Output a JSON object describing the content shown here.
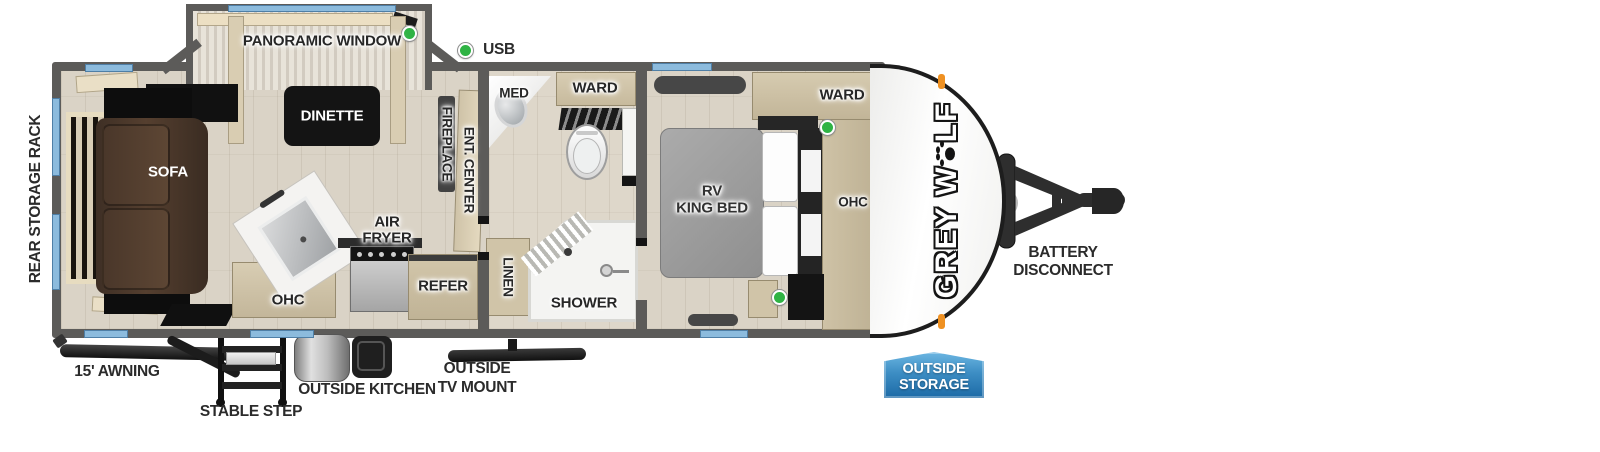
{
  "colors": {
    "wall_gray": "#5c5b59",
    "floor_wood": "#dad3c6",
    "cabinet_wood": "#d0c4a8",
    "window_blue": "#8cbbdd",
    "usb_green": "#2fb344",
    "sofa_brown": "#4e3a2c",
    "badge_blue": "#1c6aa6",
    "marker_orange": "#ef9122"
  },
  "legend": {
    "usb_label": "USB"
  },
  "rooms": {
    "living": {
      "panoramic_window": "PANORAMIC WINDOW",
      "dinette": "DINETTE",
      "sofa": "SOFA",
      "ohc": "OHC",
      "air_fryer": {
        "line1": "AIR",
        "line2": "FRYER"
      },
      "refer": "REFER",
      "fireplace": "FIREPLACE",
      "ent_center": "ENT. CENTER"
    },
    "bath": {
      "med": "MED",
      "ward": "WARD",
      "linen": "LINEN",
      "shower": "SHOWER"
    },
    "bedroom": {
      "bed": {
        "line1": "RV",
        "line2": "KING BED"
      },
      "ward": "WARD",
      "ohc": "OHC"
    }
  },
  "exterior": {
    "rear_storage_rack": "REAR STORAGE RACK",
    "awning": "15' AWNING",
    "stable_step": "STABLE STEP",
    "outside_kitchen": "OUTSIDE KITCHEN",
    "outside_tv_mount": {
      "line1": "OUTSIDE",
      "line2": "TV MOUNT"
    },
    "battery_disconnect": {
      "line1": "BATTERY",
      "line2": "DISCONNECT"
    },
    "outside_storage_badge": {
      "line1": "OUTSIDE",
      "line2": "STORAGE"
    },
    "brand": {
      "prefix": "GREY W",
      "suffix": "LF"
    }
  }
}
